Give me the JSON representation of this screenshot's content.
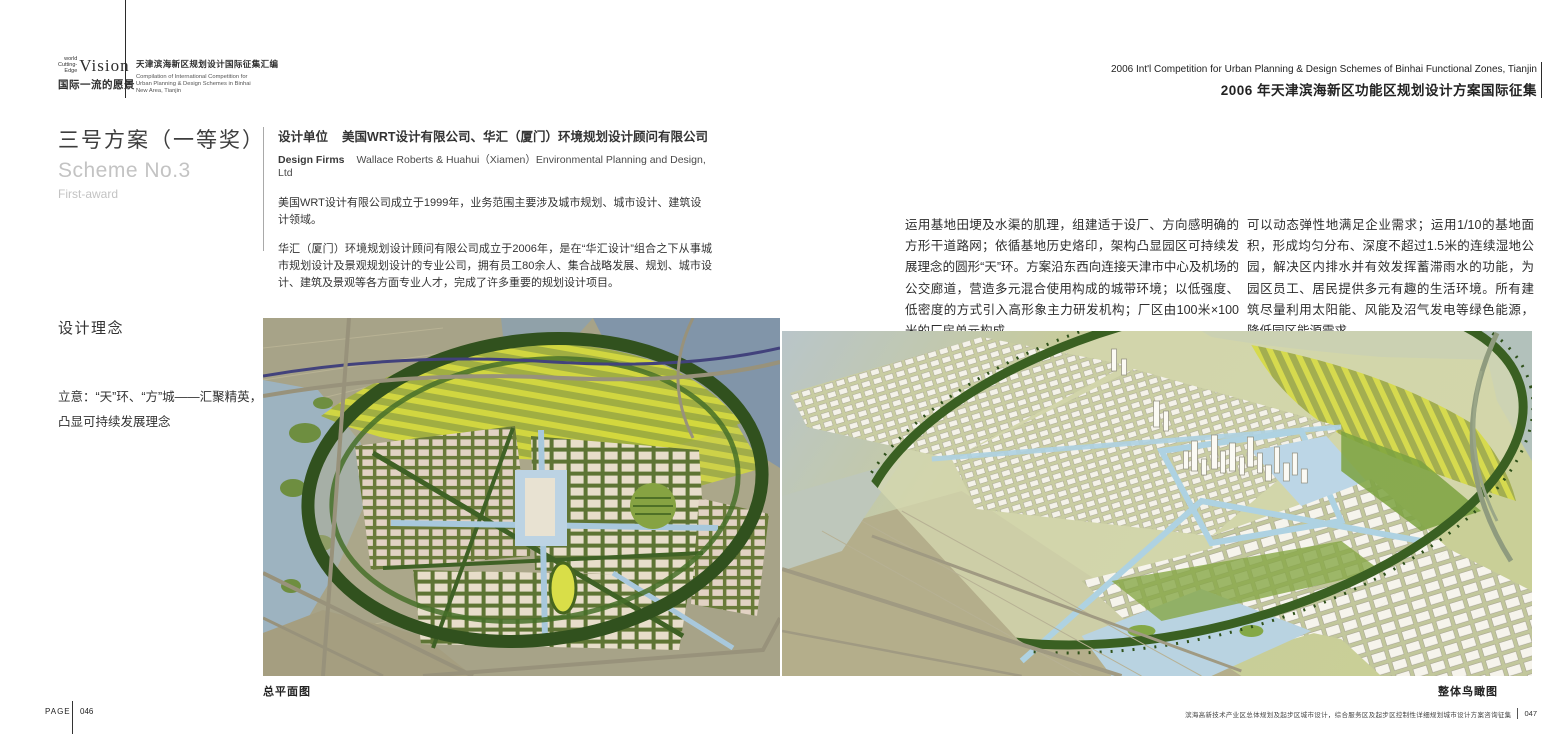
{
  "header": {
    "logo": {
      "pre_line1": "world",
      "pre_line2": "Cutting-Edge",
      "title": "Vision",
      "subtitle": "国际一流的愿景"
    },
    "series": {
      "title_cn": "天津滨海新区规划设计国际征集汇编",
      "title_en": "Compilation of International Competition for Urban Planning & Design Schemes in Binhai New Area, Tianjin"
    },
    "competition": {
      "line_en": "2006 Int'l Competition for Urban Planning & Design Schemes of Binhai Functional Zones, Tianjin",
      "line_cn": "2006 年天津滨海新区功能区规划设计方案国际征集"
    }
  },
  "scheme": {
    "title_cn": "三号方案（一等奖）",
    "title_en": "Scheme No.3",
    "award": "First-award"
  },
  "firms": {
    "label_cn": "设计单位",
    "value_cn": "美国WRT设计有限公司、华汇（厦门）环境规划设计顾问有限公司",
    "label_en": "Design Firms",
    "value_en": "Wallace Roberts & Huahui（Xiamen）Environmental Planning and Design, Ltd",
    "profile_wrt": "美国WRT设计有限公司成立于1999年，业务范围主要涉及城市规划、城市设计、建筑设计领域。",
    "profile_huahui": "华汇（厦门）环境规划设计顾问有限公司成立于2006年，是在“华汇设计”组合之下从事城市规划设计及景观规划设计的专业公司，拥有员工80余人、集合战略发展、规划、城市设计、建筑及景观等各方面专业人才，完成了许多重要的规划设计项目。"
  },
  "concept": {
    "heading": "设计理念",
    "statement": "立意：“天”环、“方”城——汇聚精英，凸显可持续发展理念"
  },
  "description": {
    "col1": "运用基地田埂及水渠的肌理，组建适于设厂、方向感明确的方形干道路网；依循基地历史烙印，架构凸显园区可持续发展理念的圆形“天”环。方案沿东西向连接天津市中心及机场的公交廊道，营造多元混合使用构成的城带环境；以低强度、低密度的方式引入高形象主力研发机构；厂区由100米×100米的厂房单元构成，",
    "col2": "可以动态弹性地满足企业需求；运用1/10的基地面积，形成均匀分布、深度不超过1.5米的连续湿地公园，解决区内排水并有效发挥蓄滞雨水的功能，为园区员工、居民提供多元有趣的生活环境。所有建筑尽量利用太阳能、风能及沼气发电等绿色能源，降低园区能源需求。"
  },
  "figures": {
    "plan_caption": "总平面图",
    "aerial_caption": "整体鸟瞰图"
  },
  "footer": {
    "page_label": "PAGE",
    "page_left": "046",
    "chapter": "滨海高新技术产业区总体规划及起步区城市设计，综合服务区及起步区控制性详细规划城市设计方案咨询征集",
    "page_right": "047"
  },
  "colors": {
    "plan_ring_green": "#31511e",
    "plan_water": "#8195a9",
    "plan_farmland_yellow": "#d3d83c",
    "plan_block_beige": "#e7ddca",
    "aerial_base": "#c7cb9c",
    "building_white": "#f4f2e9",
    "canal_blue": "#aed2e2"
  }
}
